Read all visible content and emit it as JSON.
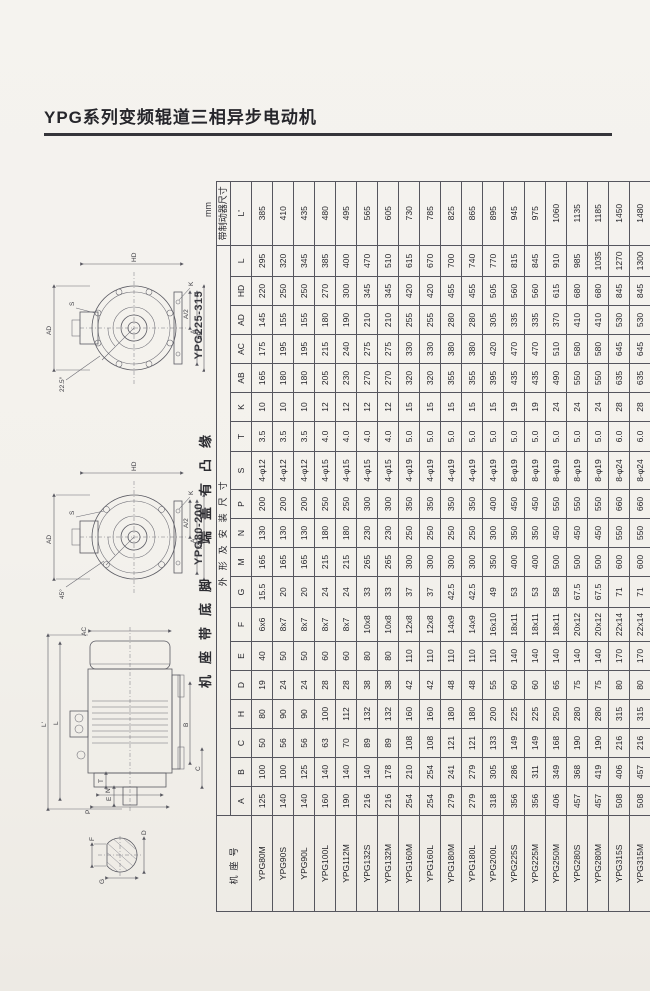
{
  "page": {
    "title": "YPG系列变频辊道三相异步电动机",
    "unit_label": "mm"
  },
  "drawings": {
    "flange_view_large": {
      "label": "YPG225-315",
      "dim_ad": "AD",
      "dim_hd": "HD",
      "dim_k": "K",
      "dim_s": "S",
      "dim_a_half": "A/2",
      "dim_a": "A",
      "dim_ab": "AB",
      "angle": "22.5°"
    },
    "flange_view_small": {
      "label": "YPG80-200",
      "dim_ad": "AD",
      "dim_hd": "HD",
      "dim_k": "K",
      "dim_s": "S",
      "dim_a_half": "A/2",
      "dim_a": "A",
      "dim_ab": "AB",
      "angle": "45°"
    },
    "side_view": {
      "dim_l2": "L'",
      "dim_l": "L",
      "dim_ac": "AC",
      "dim_b": "B",
      "dim_c": "C",
      "dim_e": "E",
      "dim_t": "T",
      "dim_n": "N",
      "dim_p": "P"
    },
    "shaft_section": {
      "dim_f": "F",
      "dim_d": "D",
      "dim_g": "G"
    }
  },
  "table": {
    "caption": "机座带底脚　端盖有凸缘",
    "frame_col_header": "机座号",
    "group_headers": {
      "main": "外形及安装尺寸",
      "brake": "带制动器尺寸"
    },
    "columns": [
      "A",
      "B",
      "C",
      "H",
      "D",
      "E",
      "F",
      "G",
      "M",
      "N",
      "P",
      "S",
      "T",
      "K",
      "AB",
      "AC",
      "AD",
      "HD",
      "L",
      "L'"
    ],
    "rows": [
      {
        "model": "YPG80M",
        "values": [
          "125",
          "100",
          "50",
          "80",
          "19",
          "40",
          "6x6",
          "15.5",
          "165",
          "130",
          "200",
          "4-φ12",
          "3.5",
          "10",
          "165",
          "175",
          "145",
          "220",
          "295",
          "385"
        ]
      },
      {
        "model": "YPG90S",
        "values": [
          "140",
          "100",
          "56",
          "90",
          "24",
          "50",
          "8x7",
          "20",
          "165",
          "130",
          "200",
          "4-φ12",
          "3.5",
          "10",
          "180",
          "195",
          "155",
          "250",
          "320",
          "410"
        ]
      },
      {
        "model": "YPG90L",
        "values": [
          "140",
          "125",
          "56",
          "90",
          "24",
          "50",
          "8x7",
          "20",
          "165",
          "130",
          "200",
          "4-φ12",
          "3.5",
          "10",
          "180",
          "195",
          "155",
          "250",
          "345",
          "435"
        ]
      },
      {
        "model": "YPG100L",
        "values": [
          "160",
          "140",
          "63",
          "100",
          "28",
          "60",
          "8x7",
          "24",
          "215",
          "180",
          "250",
          "4-φ15",
          "4.0",
          "12",
          "205",
          "215",
          "180",
          "270",
          "385",
          "480"
        ]
      },
      {
        "model": "YPG112M",
        "values": [
          "190",
          "140",
          "70",
          "112",
          "28",
          "60",
          "8x7",
          "24",
          "215",
          "180",
          "250",
          "4-φ15",
          "4.0",
          "12",
          "230",
          "240",
          "190",
          "300",
          "400",
          "495"
        ]
      },
      {
        "model": "YPG132S",
        "values": [
          "216",
          "140",
          "89",
          "132",
          "38",
          "80",
          "10x8",
          "33",
          "265",
          "230",
          "300",
          "4-φ15",
          "4.0",
          "12",
          "270",
          "275",
          "210",
          "345",
          "470",
          "565"
        ]
      },
      {
        "model": "YPG132M",
        "values": [
          "216",
          "178",
          "89",
          "132",
          "38",
          "80",
          "10x8",
          "33",
          "265",
          "230",
          "300",
          "4-φ15",
          "4.0",
          "12",
          "270",
          "275",
          "210",
          "345",
          "510",
          "605"
        ]
      },
      {
        "model": "YPG160M",
        "values": [
          "254",
          "210",
          "108",
          "160",
          "42",
          "110",
          "12x8",
          "37",
          "300",
          "250",
          "350",
          "4-φ19",
          "5.0",
          "15",
          "320",
          "330",
          "255",
          "420",
          "615",
          "730"
        ]
      },
      {
        "model": "YPG160L",
        "values": [
          "254",
          "254",
          "108",
          "160",
          "42",
          "110",
          "12x8",
          "37",
          "300",
          "250",
          "350",
          "4-φ19",
          "5.0",
          "15",
          "320",
          "330",
          "255",
          "420",
          "670",
          "785"
        ]
      },
      {
        "model": "YPG180M",
        "values": [
          "279",
          "241",
          "121",
          "180",
          "48",
          "110",
          "14x9",
          "42.5",
          "300",
          "250",
          "350",
          "4-φ19",
          "5.0",
          "15",
          "355",
          "380",
          "280",
          "455",
          "700",
          "825"
        ]
      },
      {
        "model": "YPG180L",
        "values": [
          "279",
          "279",
          "121",
          "180",
          "48",
          "110",
          "14x9",
          "42.5",
          "300",
          "250",
          "350",
          "4-φ19",
          "5.0",
          "15",
          "355",
          "380",
          "280",
          "455",
          "740",
          "865"
        ]
      },
      {
        "model": "YPG200L",
        "values": [
          "318",
          "305",
          "133",
          "200",
          "55",
          "110",
          "16x10",
          "49",
          "350",
          "300",
          "400",
          "4-φ19",
          "5.0",
          "15",
          "395",
          "420",
          "305",
          "505",
          "770",
          "895"
        ]
      },
      {
        "model": "YPG225S",
        "values": [
          "356",
          "286",
          "149",
          "225",
          "60",
          "140",
          "18x11",
          "53",
          "400",
          "350",
          "450",
          "8-φ19",
          "5.0",
          "19",
          "435",
          "470",
          "335",
          "560",
          "815",
          "945"
        ]
      },
      {
        "model": "YPG225M",
        "values": [
          "356",
          "311",
          "149",
          "225",
          "60",
          "140",
          "18x11",
          "53",
          "400",
          "350",
          "450",
          "8-φ19",
          "5.0",
          "19",
          "435",
          "470",
          "335",
          "560",
          "845",
          "975"
        ]
      },
      {
        "model": "YPG250M",
        "values": [
          "406",
          "349",
          "168",
          "250",
          "65",
          "140",
          "18x11",
          "58",
          "500",
          "450",
          "550",
          "8-φ19",
          "5.0",
          "24",
          "490",
          "510",
          "370",
          "615",
          "910",
          "1060"
        ]
      },
      {
        "model": "YPG280S",
        "values": [
          "457",
          "368",
          "190",
          "280",
          "75",
          "140",
          "20x12",
          "67.5",
          "500",
          "450",
          "550",
          "8-φ19",
          "5.0",
          "24",
          "550",
          "580",
          "410",
          "680",
          "985",
          "1135"
        ]
      },
      {
        "model": "YPG280M",
        "values": [
          "457",
          "419",
          "190",
          "280",
          "75",
          "140",
          "20x12",
          "67.5",
          "500",
          "450",
          "550",
          "8-φ19",
          "5.0",
          "24",
          "550",
          "580",
          "410",
          "680",
          "1035",
          "1185"
        ]
      },
      {
        "model": "YPG315S",
        "values": [
          "508",
          "406",
          "216",
          "315",
          "80",
          "170",
          "22x14",
          "71",
          "600",
          "550",
          "660",
          "8-φ24",
          "6.0",
          "28",
          "635",
          "645",
          "530",
          "845",
          "1270",
          "1450"
        ]
      },
      {
        "model": "YPG315M",
        "values": [
          "508",
          "457",
          "216",
          "315",
          "80",
          "170",
          "22x14",
          "71",
          "600",
          "550",
          "660",
          "8-φ24",
          "6.0",
          "28",
          "635",
          "645",
          "530",
          "845",
          "1300",
          "1480"
        ]
      },
      {
        "model": "YPG315L",
        "values": [
          "508",
          "508",
          "216",
          "315",
          "80",
          "170",
          "22x14",
          "71",
          "600",
          "550",
          "660",
          "8-φ24",
          "6.0",
          "28",
          "635",
          "645",
          "530",
          "845",
          "1300",
          "1480"
        ]
      }
    ]
  }
}
